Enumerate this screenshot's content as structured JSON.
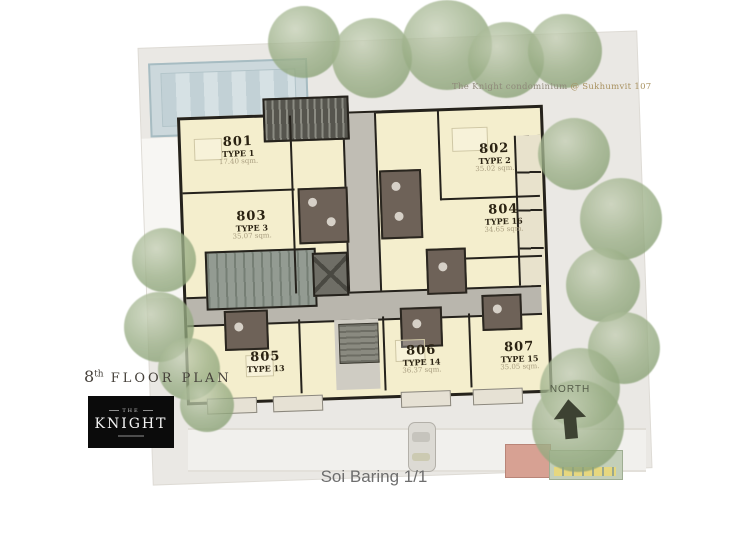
{
  "watermark": {
    "main": "The Knight condominium",
    "suffix": "@ Sukhumvit 107"
  },
  "title": {
    "floor_number": "8",
    "floor_ordinal": "th",
    "floor_text": "FLOOR PLAN"
  },
  "logo": {
    "pre": "THE",
    "name": "KNIGHT"
  },
  "compass": {
    "label": "NORTH"
  },
  "street": {
    "label": "Soi Baring 1/1"
  },
  "units": [
    {
      "id": "801",
      "type": "TYPE 1",
      "area": "17.40 sqm."
    },
    {
      "id": "802",
      "type": "TYPE 2",
      "area": "35.02 sqm."
    },
    {
      "id": "803",
      "type": "TYPE 3",
      "area": "35.07 sqm."
    },
    {
      "id": "804",
      "type": "TYPE 16",
      "area": "34.65 sqm."
    },
    {
      "id": "805",
      "type": "TYPE 13",
      "area": ""
    },
    {
      "id": "806",
      "type": "TYPE 14",
      "area": "36.37 sqm."
    },
    {
      "id": "807",
      "type": "TYPE 15",
      "area": "35.05 sqm."
    }
  ],
  "colors": {
    "unit_fill": "#f4eecd",
    "wall": "#25221c",
    "corridor": "#b9b6ad",
    "stair_core": "#939b92",
    "bathroom": "#6e6258",
    "site": "#eae8e4",
    "pool": "#ccd8dc",
    "tree": "#9cb088",
    "logo_bg": "#0b0b0b"
  }
}
